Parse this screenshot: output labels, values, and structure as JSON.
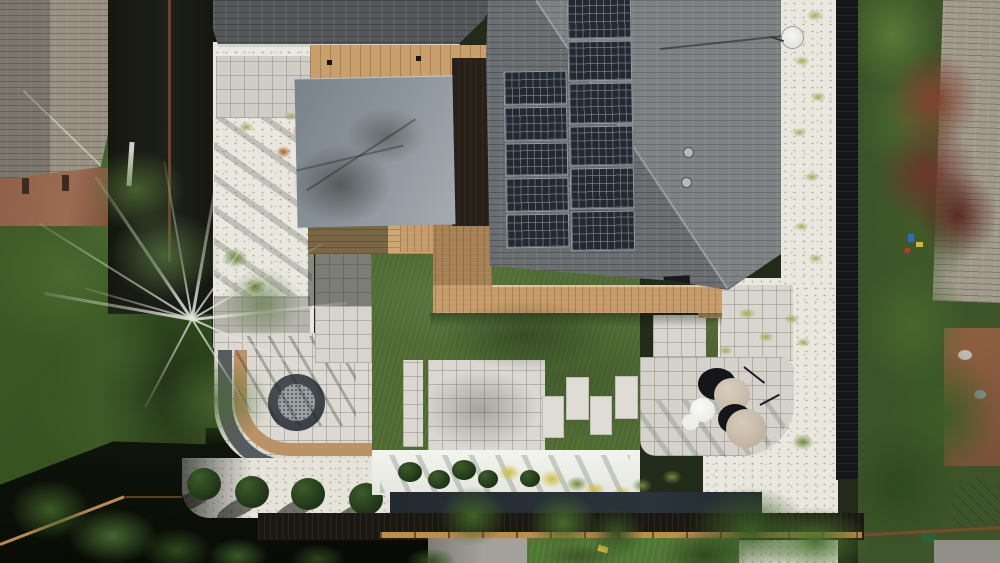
{
  "scene": {
    "description": "Aerial top-down drone photo of a modern landscaped backyard: dark-shingled house roof with rooftop solar array, gray shade canopy over a wood deck, artificial turf lawn with paver patios and stepping stones, round fire pit with curved bench wall, white gravel planting beds, round patio umbrellas, black perimeter fence and neighboring yards with trees",
    "type": "aerial-photograph",
    "time_of_day": "sunny daytime with hard shadows"
  },
  "objects": {
    "main_roof": {
      "label": "main house roof with solar array",
      "shingle_color": "#6a6e71",
      "sunlit_color": "#8b9094"
    },
    "solar_array": {
      "label": "rooftop solar panel array",
      "columns": 2,
      "panels_left_column": 5,
      "panels_right_column": 6,
      "panel_count": 11,
      "panel_color": "#232931"
    },
    "garage_roof": {
      "label": "garage roof",
      "color": "#55585a"
    },
    "neighbor_left_roof": {
      "label": "left neighbor house roof",
      "color": "#999183"
    },
    "neighbor_right_roof": {
      "label": "right neighbor house roof",
      "color": "#a29b8d"
    },
    "canopy": {
      "label": "gray shade canopy over pergola",
      "color": "#8d959c"
    },
    "pergola": {
      "label": "wood pergola top",
      "color": "#c8a06d"
    },
    "deck": {
      "label": "composite wood deck",
      "color": "#c59c69"
    },
    "turf": {
      "label": "artificial turf lawn",
      "color": "#4e6a32"
    },
    "paver_patio": {
      "label": "light paver patio",
      "color": "#d8d6ce"
    },
    "stepping_stones": {
      "label": "paver stepping stones on turf",
      "count": 4,
      "color": "#dedcd4"
    },
    "fire_pit": {
      "label": "round gas fire pit",
      "ring_color": "#41474b",
      "gravel_color": "#9ba1a4"
    },
    "bench_wall": {
      "label": "curved bench on retaining wall",
      "bench_color": "#bb9265",
      "wall_color": "#565b5f"
    },
    "shrub_row": {
      "label": "row of ball shrubs",
      "count": 5,
      "color": "#26401d"
    },
    "planting_wall": {
      "label": "white planter wall with shrubs and yellow flowers",
      "color": "#edefe9"
    },
    "gravel_beds": {
      "label": "white gravel beds with ornamental grasses",
      "color": "#eae7df"
    },
    "umbrellas": {
      "label": "round patio umbrellas",
      "beige_count": 2,
      "white_count": 1,
      "beige_color": "#cbbfae",
      "white_color": "#f2f2ef"
    },
    "fence_black": {
      "label": "black horizontal-slat fence",
      "color": "#141619"
    },
    "boardwalk": {
      "label": "dark wood boardwalk strip",
      "color": "#1b1811"
    },
    "birch_tree": {
      "label": "white-branched birch tree",
      "branch_color": "#e2e5de"
    },
    "maple_tree": {
      "label": "burgundy maple tree in neighbor yard",
      "color": "#7a3b30"
    },
    "satellite_dish": {
      "label": "white satellite dish on roof edge",
      "color": "#f1f1ee"
    },
    "greenhouse": {
      "label": "small greenhouse in right neighbor yard",
      "color": "#9aa0a2"
    }
  },
  "palette": {
    "turf_green": "#4e6a32",
    "paver_light": "#d8d6ce",
    "gravel_white": "#eae7df",
    "roof_dark": "#6a6e71",
    "solar_navy": "#232931",
    "deck_tan": "#c59c69",
    "canopy_gray": "#8d959c",
    "shadow_dark": "#0c1009",
    "foliage_green": "#44622c",
    "maple_red": "#7a3b30",
    "rust_fence": "#7d4a28",
    "sun_fence_tan": "#c28a4b"
  }
}
